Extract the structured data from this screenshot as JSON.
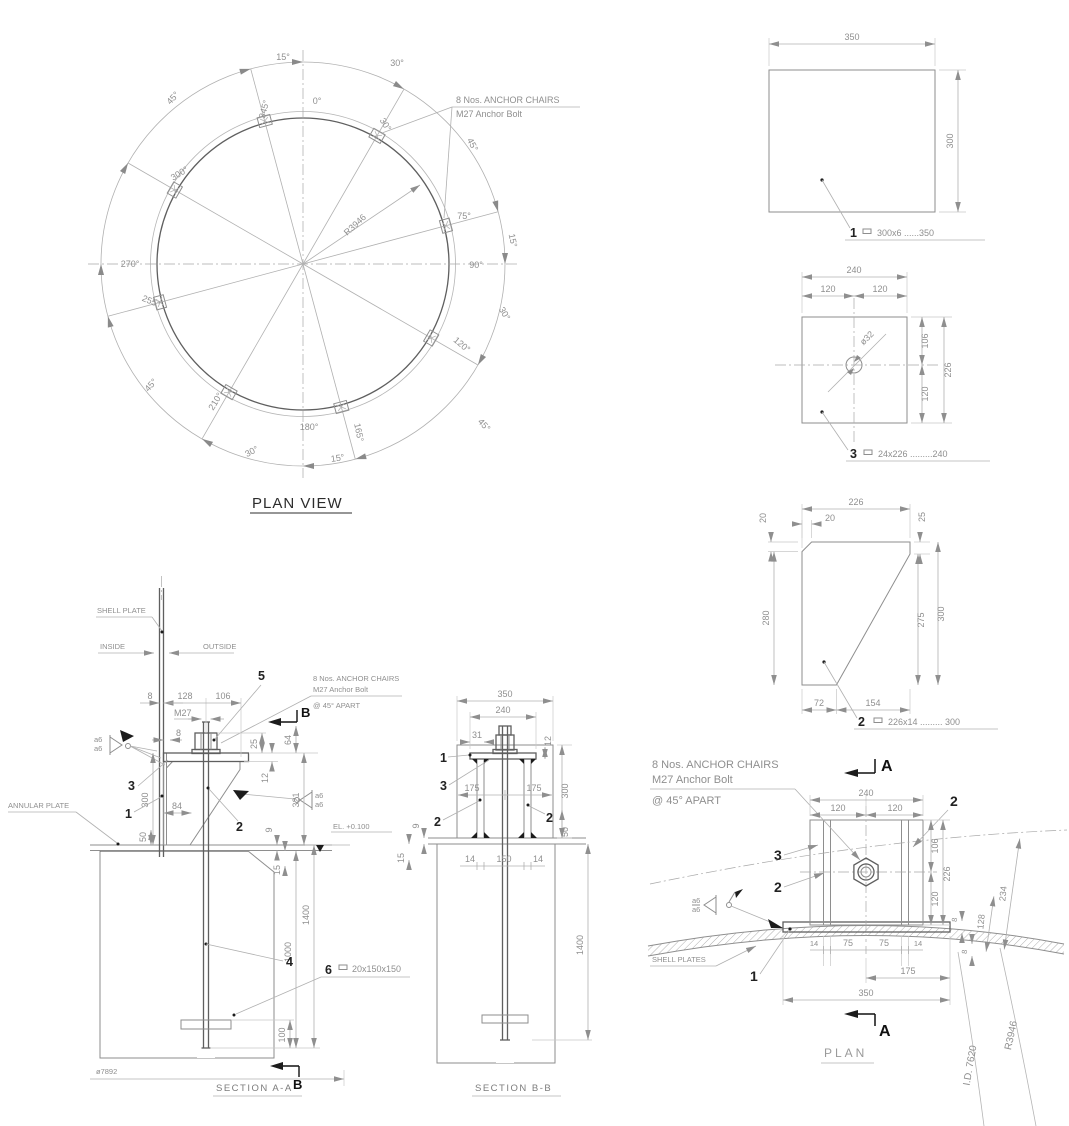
{
  "plan_view": {
    "title": "PLAN VIEW",
    "note": [
      "8 Nos. ANCHOR CHAIRS",
      "M27 Anchor Bolt"
    ],
    "radius": "R3946",
    "angles": [
      "15°",
      "30°",
      "45°",
      "345°",
      "0°",
      "30°",
      "45°",
      "300°",
      "270°",
      "255°",
      "75°",
      "90°",
      "15°",
      "30°",
      "120°",
      "45°",
      "165°",
      "180°",
      "15°",
      "210°",
      "30°",
      "45°"
    ]
  },
  "details": {
    "d1": {
      "no": "1",
      "spec": "300x6 ......350",
      "w": "350",
      "h": "300"
    },
    "d3": {
      "no": "3",
      "spec": "24x226 .........240",
      "w": "240",
      "w1": "120",
      "w2": "120",
      "hole": "ø32",
      "r1": "106",
      "r2": "120",
      "r3": "226"
    },
    "d2": {
      "no": "2",
      "spec": "226x14 ......... 300",
      "top": "226",
      "chv": "20",
      "chh": "20",
      "rch": "25",
      "left": "280",
      "r1": "275",
      "r2": "300",
      "b1": "72",
      "b2": "154"
    }
  },
  "section_aa": {
    "title": "SECTION A-A",
    "shell": "SHELL PLATE",
    "inside": "INSIDE",
    "outside": "OUTSIDE",
    "annular": "ANNULAR PLATE",
    "note": [
      "8 Nos. ANCHOR CHAIRS",
      "M27 Anchor Bolt",
      "@ 45° APART"
    ],
    "el": "EL. +0.100",
    "dia": "ø7892",
    "marker": "B",
    "weld": "a6",
    "it1": "1",
    "it2": "2",
    "it3": "3",
    "it4": "4",
    "it5": "5",
    "it6": {
      "no": "6",
      "spec": "20x150x150"
    },
    "d8a": "8",
    "d128": "128",
    "d106": "106",
    "m27": "M27",
    "d8b": "8",
    "d25": "25",
    "d12": "12",
    "d64": "64",
    "d321": "321",
    "d300": "300",
    "d84": "84",
    "d50": "50",
    "d9": "9",
    "d15": "15",
    "d1400": "1400",
    "d1000": "1000",
    "d100": "100"
  },
  "section_bb": {
    "title": "SECTION B-B",
    "d350": "350",
    "d240": "240",
    "d31": "31",
    "d12": "12",
    "d175a": "175",
    "d175b": "175",
    "d300": "300",
    "d50": "50",
    "d9": "9",
    "d15": "15",
    "d14a": "14",
    "d150": "150",
    "d14b": "14",
    "d1400": "1400",
    "it1": "1",
    "it2a": "2",
    "it2b": "2",
    "it3": "3"
  },
  "plan_detail": {
    "title": "PLAN",
    "note": [
      "8 Nos. ANCHOR CHAIRS",
      "M27 Anchor Bolt",
      "@ 45° APART"
    ],
    "marker": "A",
    "shell": "SHELL PLATES",
    "weld": "a6",
    "id_label": "I.D. 7620",
    "radius": "R3946",
    "d240": "240",
    "d120a": "120",
    "d120b": "120",
    "d106": "106",
    "d226": "226",
    "d120c": "120",
    "d234": "234",
    "d128": "128",
    "d8a": "8",
    "d8b": "8",
    "d14a": "14",
    "d75a": "75",
    "d75b": "75",
    "d14b": "14",
    "d175": "175",
    "d350": "350",
    "it1": "1",
    "it2a": "2",
    "it2b": "2",
    "it3": "3"
  }
}
